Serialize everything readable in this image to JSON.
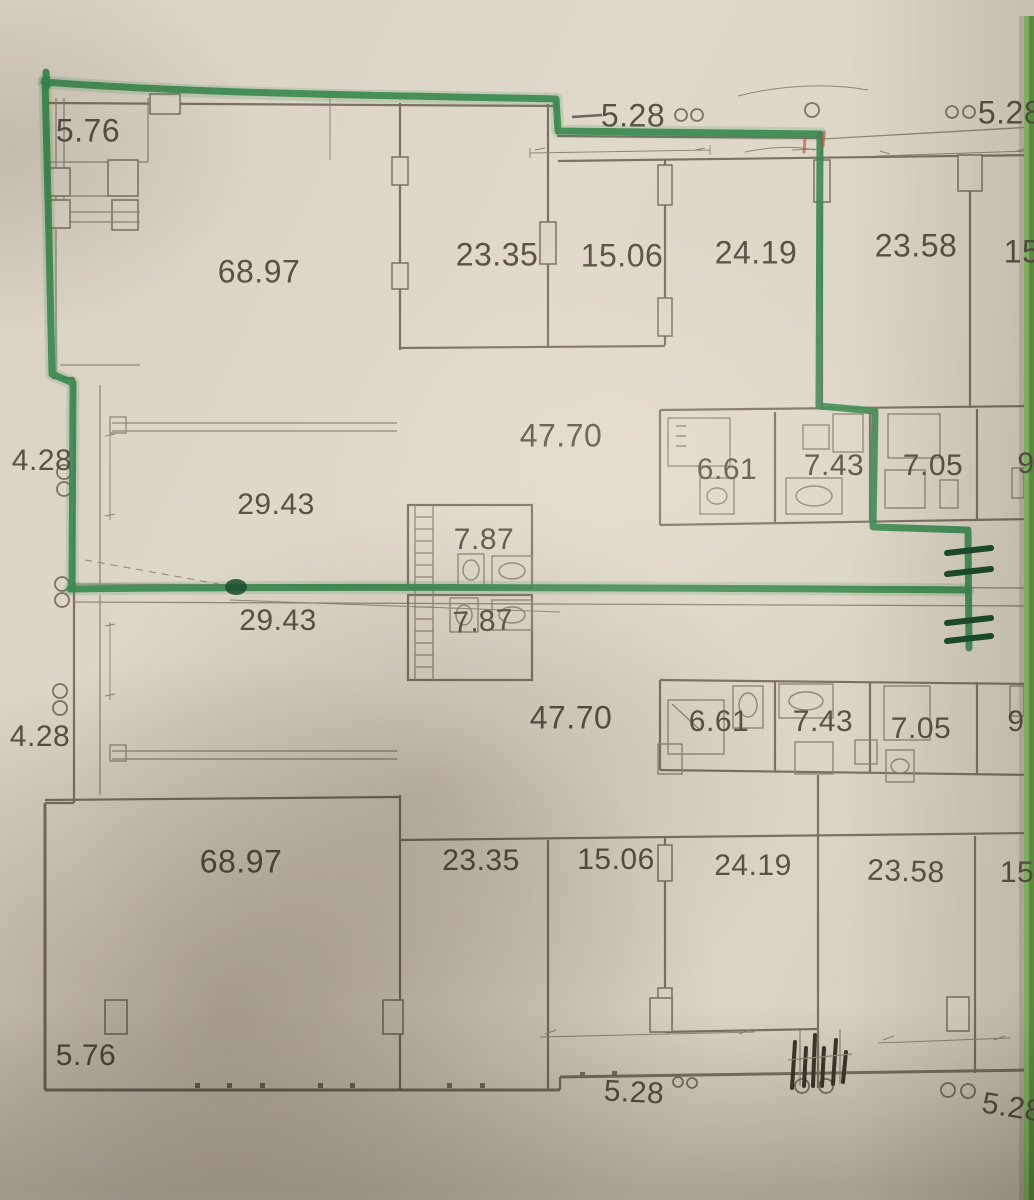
{
  "meta": {
    "description": "Photographed architectural floor plan (two mirrored apartment levels) with a green marker outline drawn around the upper-left unit",
    "units_hint": "room areas in square meters"
  },
  "colors": {
    "paper": "#ddd6c8",
    "wall": "#7b7263",
    "wall_thin": "#8f8776",
    "ink": "#5a5245",
    "marker": "#3c8a50",
    "marker_dark": "#1b4f2d",
    "edge1": "#8cc46d",
    "edge2": "#5f9e42"
  },
  "labels": [
    {
      "id": "area-5-76-top",
      "text": "5.76",
      "x": 88,
      "y": 131,
      "size": 32
    },
    {
      "id": "area-68-97-top",
      "text": "68.97",
      "x": 259,
      "y": 272,
      "size": 32
    },
    {
      "id": "area-23-35-top",
      "text": "23.35",
      "x": 497,
      "y": 255,
      "size": 32
    },
    {
      "id": "area-15-06-top",
      "text": "15.06",
      "x": 622,
      "y": 256,
      "size": 32
    },
    {
      "id": "area-24-19-top",
      "text": "24.19",
      "x": 756,
      "y": 253,
      "size": 32
    },
    {
      "id": "area-23-58-top",
      "text": "23.58",
      "x": 916,
      "y": 246,
      "size": 32
    },
    {
      "id": "area-15-top-cut",
      "text": "15",
      "x": 1022,
      "y": 252,
      "size": 32
    },
    {
      "id": "dim-5-28-top",
      "text": "5.28",
      "x": 633,
      "y": 116,
      "size": 32
    },
    {
      "id": "dim-5-28-top-right",
      "text": "5.28",
      "x": 1010,
      "y": 113,
      "size": 32
    },
    {
      "id": "area-47-70-top",
      "text": "47.70",
      "x": 561,
      "y": 436,
      "size": 32
    },
    {
      "id": "area-6-61-top",
      "text": "6.61",
      "x": 727,
      "y": 470,
      "size": 30
    },
    {
      "id": "area-7-43-top",
      "text": "7.43",
      "x": 834,
      "y": 466,
      "size": 30
    },
    {
      "id": "area-7-05-top",
      "text": "7.05",
      "x": 933,
      "y": 466,
      "size": 30
    },
    {
      "id": "area-9-top-cut",
      "text": "9",
      "x": 1026,
      "y": 464,
      "size": 30
    },
    {
      "id": "dim-4-28-top",
      "text": "4.28",
      "x": 42,
      "y": 461,
      "size": 30
    },
    {
      "id": "area-29-43-top",
      "text": "29.43",
      "x": 276,
      "y": 505,
      "size": 30
    },
    {
      "id": "area-7-87-top",
      "text": "7.87",
      "x": 484,
      "y": 540,
      "size": 30
    },
    {
      "id": "area-29-43-bottom",
      "text": "29.43",
      "x": 278,
      "y": 621,
      "size": 30
    },
    {
      "id": "area-7-87-bottom",
      "text": "7.87",
      "x": 483,
      "y": 622,
      "size": 30,
      "rot": -3
    },
    {
      "id": "dim-4-28-bottom",
      "text": "4.28",
      "x": 40,
      "y": 737,
      "size": 30
    },
    {
      "id": "area-47-70-bottom",
      "text": "47.70",
      "x": 571,
      "y": 718,
      "size": 32
    },
    {
      "id": "area-6-61-bottom",
      "text": "6.61",
      "x": 719,
      "y": 722,
      "size": 30
    },
    {
      "id": "area-7-43-bottom",
      "text": "7.43",
      "x": 823,
      "y": 722,
      "size": 30
    },
    {
      "id": "area-7-05-bottom",
      "text": "7.05",
      "x": 921,
      "y": 729,
      "size": 30
    },
    {
      "id": "area-9-bottom-cut",
      "text": "9",
      "x": 1016,
      "y": 722,
      "size": 30
    },
    {
      "id": "area-68-97-bottom",
      "text": "68.97",
      "x": 241,
      "y": 862,
      "size": 32
    },
    {
      "id": "area-23-35-bottom",
      "text": "23.35",
      "x": 481,
      "y": 861,
      "size": 30
    },
    {
      "id": "area-15-06-bottom",
      "text": "15.06",
      "x": 616,
      "y": 860,
      "size": 30
    },
    {
      "id": "area-24-19-bottom",
      "text": "24.19",
      "x": 753,
      "y": 866,
      "size": 30
    },
    {
      "id": "area-23-58-bottom",
      "text": "23.58",
      "x": 906,
      "y": 872,
      "size": 30,
      "rot": 2
    },
    {
      "id": "area-15-bottom-cut",
      "text": "15",
      "x": 1017,
      "y": 873,
      "size": 30
    },
    {
      "id": "dim-5-76-bottom",
      "text": "5.76",
      "x": 86,
      "y": 1056,
      "size": 30
    },
    {
      "id": "dim-5-28-bottom",
      "text": "5.28",
      "x": 634,
      "y": 1093,
      "size": 30,
      "rot": 3
    },
    {
      "id": "dim-5-28-bottom-right",
      "text": "5.28",
      "x": 1012,
      "y": 1108,
      "size": 30,
      "rot": 9
    }
  ]
}
